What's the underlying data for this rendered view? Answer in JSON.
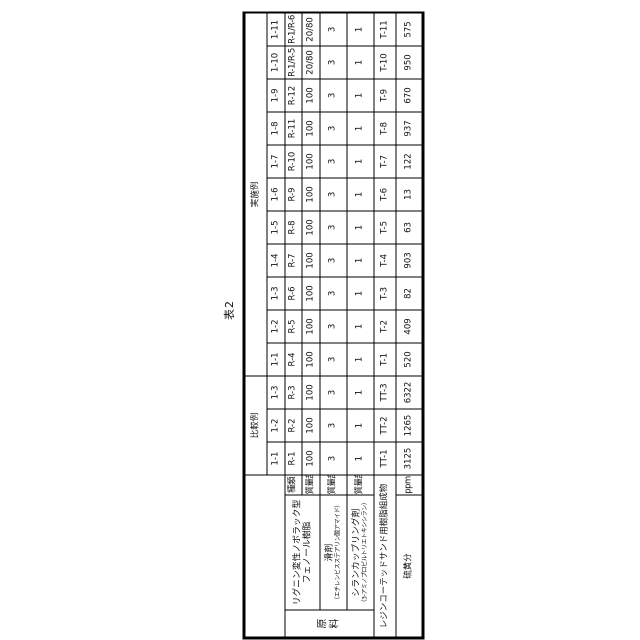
{
  "page": {
    "title": "表2"
  },
  "table": {
    "groups": [
      {
        "label": "比較例",
        "span": 3
      },
      {
        "label": "実施例",
        "span": 11
      }
    ],
    "column_ids": [
      "1-1",
      "1-2",
      "1-3",
      "1-1",
      "1-2",
      "1-3",
      "1-4",
      "1-5",
      "1-6",
      "1-7",
      "1-8",
      "1-9",
      "1-10",
      "1-11"
    ],
    "raw_material_label": "原料",
    "resin": {
      "name_line1": "リグニン変性ノボラック型",
      "name_line2": "フェノール樹脂",
      "kind_label": "種類",
      "mass_label": "質量部",
      "kinds": [
        "R-1",
        "R-2",
        "R-3",
        "R-4",
        "R-5",
        "R-6",
        "R-7",
        "R-8",
        "R-9",
        "R-10",
        "R-11",
        "R-12",
        "R-1/R-5",
        "R-1/R-6"
      ],
      "mass": [
        "100",
        "100",
        "100",
        "100",
        "100",
        "100",
        "100",
        "100",
        "100",
        "100",
        "100",
        "100",
        "20/80",
        "20/80"
      ]
    },
    "lubricant": {
      "name": "滑剤",
      "note": "（エチレンビスステアリン酸アマイド）",
      "mass_label": "質量部",
      "values": [
        "3",
        "3",
        "3",
        "3",
        "3",
        "3",
        "3",
        "3",
        "3",
        "3",
        "3",
        "3",
        "3",
        "3"
      ]
    },
    "silane": {
      "name": "シランカップリング剤",
      "note": "（3-アミノプロピルトリエトキシシラン）",
      "mass_label": "質量部",
      "values": [
        "1",
        "1",
        "1",
        "1",
        "1",
        "1",
        "1",
        "1",
        "1",
        "1",
        "1",
        "1",
        "1",
        "1"
      ]
    },
    "rcs": {
      "label": "レジンコーテッドサンド用樹脂組成物",
      "values": [
        "TT-1",
        "TT-2",
        "TT-3",
        "T-1",
        "T-2",
        "T-3",
        "T-4",
        "T-5",
        "T-6",
        "T-7",
        "T-8",
        "T-9",
        "T-10",
        "T-11"
      ]
    },
    "sulfur": {
      "label": "硫黄分",
      "unit": "ppm",
      "values": [
        "3125",
        "1265",
        "6322",
        "520",
        "409",
        "82",
        "903",
        "63",
        "13",
        "122",
        "937",
        "670",
        "950",
        "575"
      ]
    }
  }
}
